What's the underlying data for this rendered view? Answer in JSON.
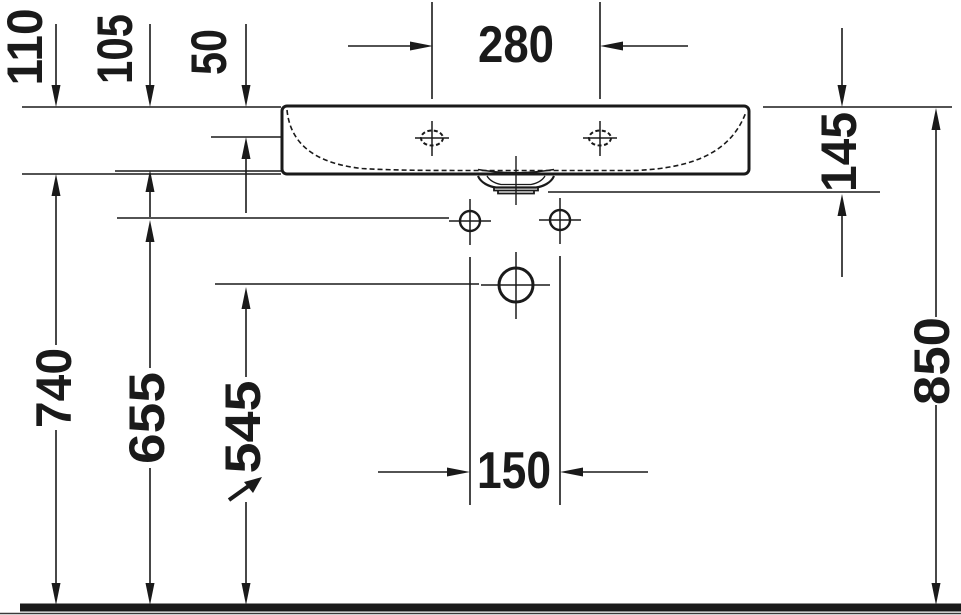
{
  "dims": {
    "d110": "110",
    "d105": "105",
    "d50": "50",
    "d280": "280",
    "d145": "145",
    "d850": "850",
    "d740": "740",
    "d655": "655",
    "d545": "545",
    "d150": "150"
  },
  "colors": {
    "ink": "#1a1a1a",
    "background": "#ffffff"
  }
}
